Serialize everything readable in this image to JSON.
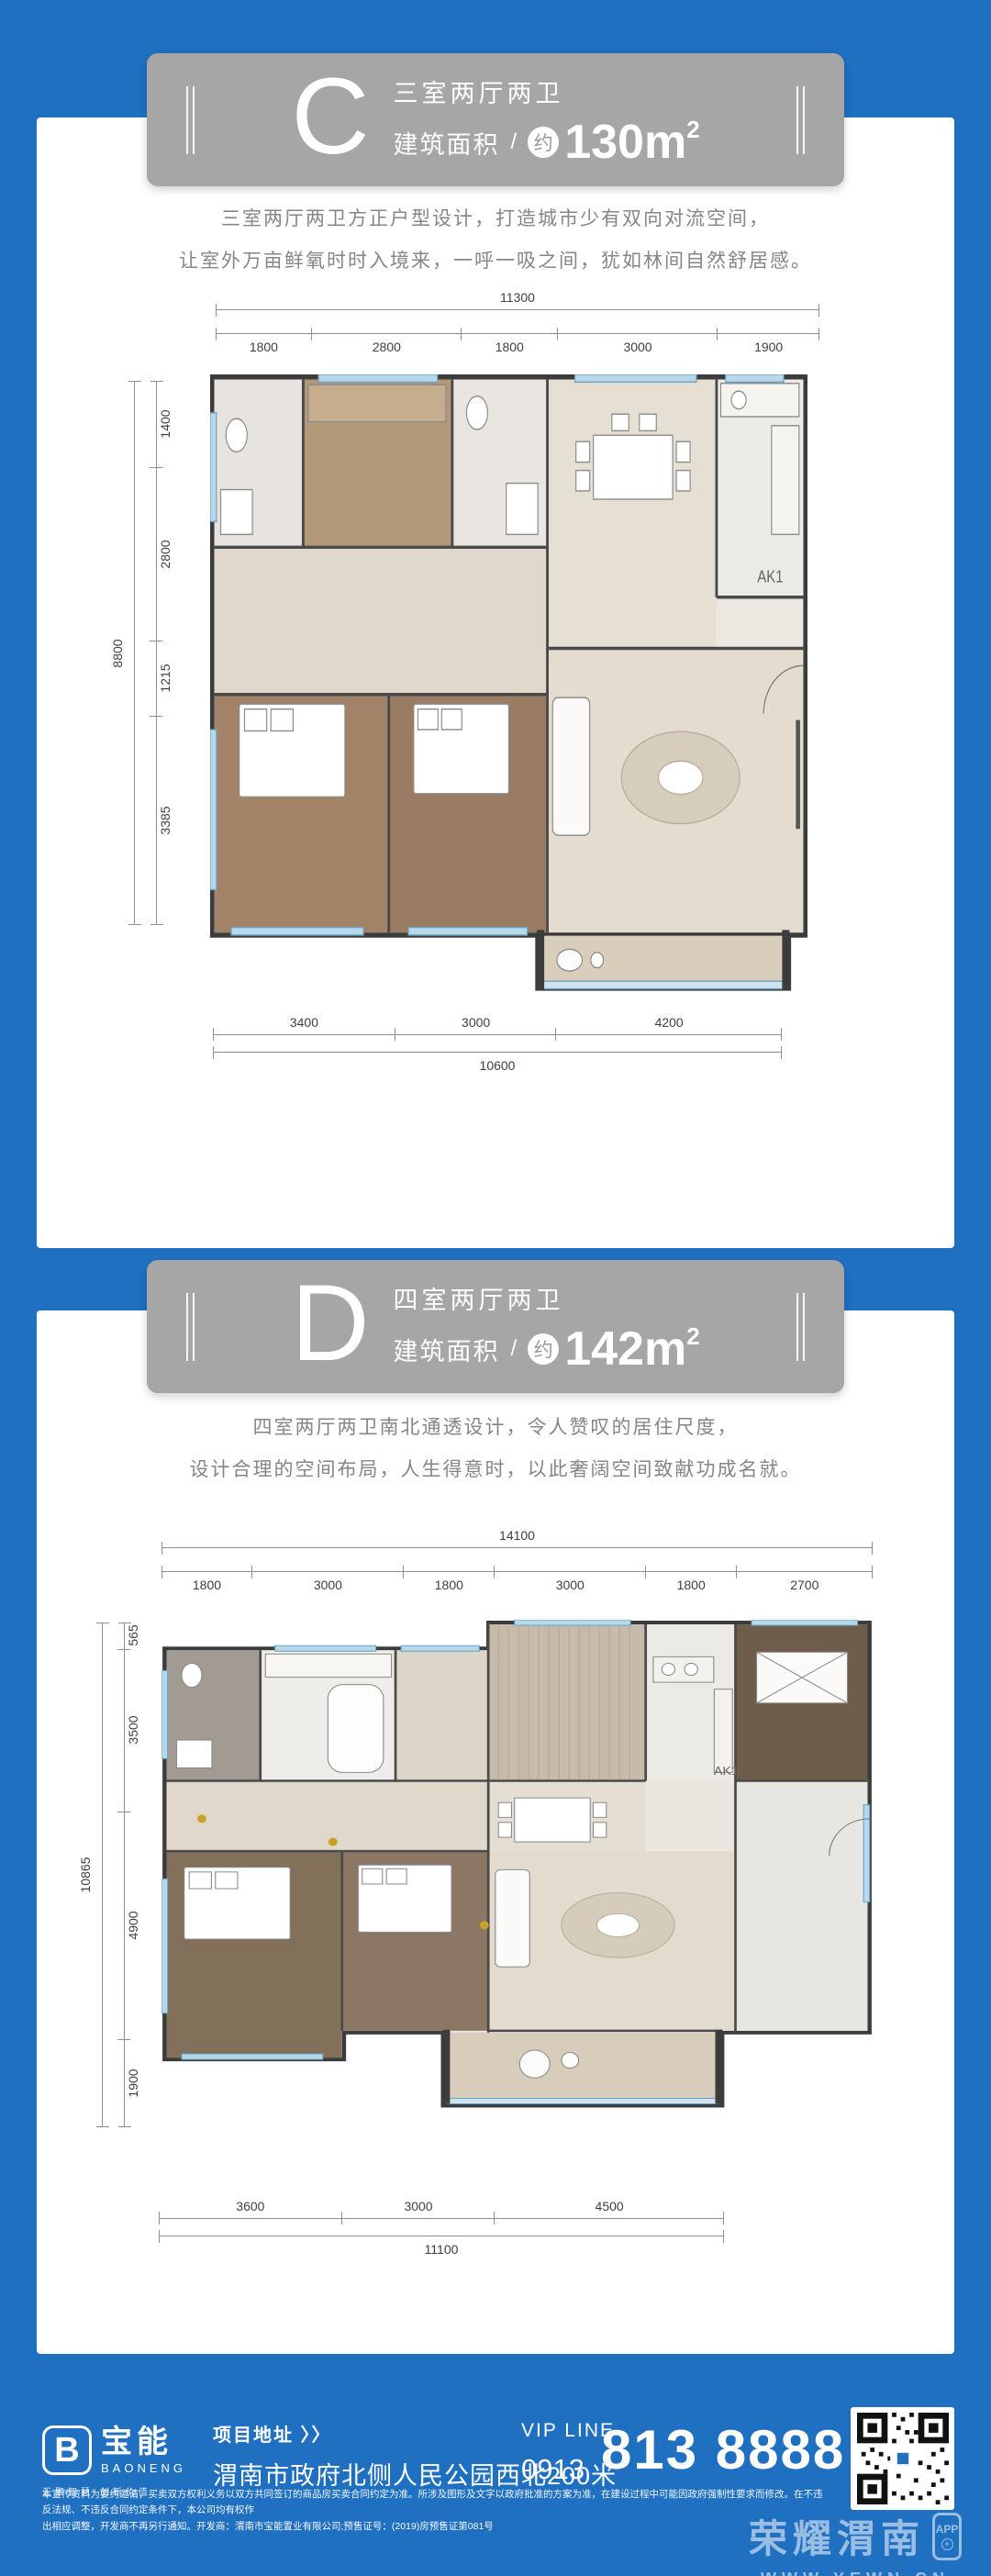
{
  "page": {
    "bg_color": "#2070c2",
    "card_color": "#ffffff",
    "badge_color": "#a6a6a6"
  },
  "plan_c": {
    "letter": "C",
    "type_label": "三室两厅两卫",
    "area_label": "建筑面积",
    "area_sep": "/",
    "area_approx": "约",
    "area_value": "130m",
    "area_sup": "2",
    "desc_line1": "三室两厅两卫方正户型设计，打造城市少有双向对流空间，",
    "desc_line2": "让室外万亩鲜氧时时入境来，一呼一吸之间，犹如林间自然舒居感。",
    "annotation": "AK1",
    "dims": {
      "top": {
        "total": "11300",
        "segments": [
          "1800",
          "2800",
          "1800",
          "3000",
          "1900"
        ]
      },
      "left": {
        "total": "8800",
        "segments": [
          "1400",
          "2800",
          "1215",
          "3385"
        ]
      },
      "bottom": {
        "total": "10600",
        "segments": [
          "3400",
          "3000",
          "4200"
        ]
      }
    }
  },
  "plan_d": {
    "letter": "D",
    "type_label": "四室两厅两卫",
    "area_label": "建筑面积",
    "area_sep": "/",
    "area_approx": "约",
    "area_value": "142m",
    "area_sup": "2",
    "desc_line1": "四室两厅两卫南北通透设计，令人赞叹的居住尺度，",
    "desc_line2": "设计合理的空间布局，人生得意时，以此奢阔空间致献功成名就。",
    "annotation": "AK1",
    "dims": {
      "top": {
        "total": "14100",
        "segments": [
          "1800",
          "3000",
          "1800",
          "3000",
          "1800",
          "2700"
        ]
      },
      "left": {
        "total": "10865",
        "segments": [
          "565",
          "3500",
          "4900",
          "1900"
        ]
      },
      "bottom": {
        "total": "11100",
        "segments": [
          "3600",
          "3000",
          "4500"
        ]
      }
    }
  },
  "footer": {
    "logo_letter": "B",
    "logo_name": "宝能",
    "logo_sub": "BAONENG",
    "logo_tagline": "汇聚智慧 创新价值",
    "address_label": "项目地址 〉〉",
    "address": "渭南市政府北侧人民公园西北200米",
    "vip_label": "VIP LINE",
    "phone_prefix": "0913",
    "phone_number": "813 8888",
    "disclaimer_line1": "本宣传资料为要约邀请，买卖双方权利义务以双方共同签订的商品房买卖合同约定为准。所涉及图形及文字以政府批准的方案为准，在建设过程中可能因政府强制性要求而修改。在不违反法规、不违反合同约定条件下，本公司均有权作",
    "disclaimer_line2": "出相应调整，开发商不再另行通知。开发商：渭南市宝能置业有限公司;预售证号：(2019)房预售证第081号"
  },
  "watermark": {
    "title": "荣耀渭南",
    "app_label": "APP",
    "plus": "+",
    "url": "WWW.YEWN.CN"
  }
}
